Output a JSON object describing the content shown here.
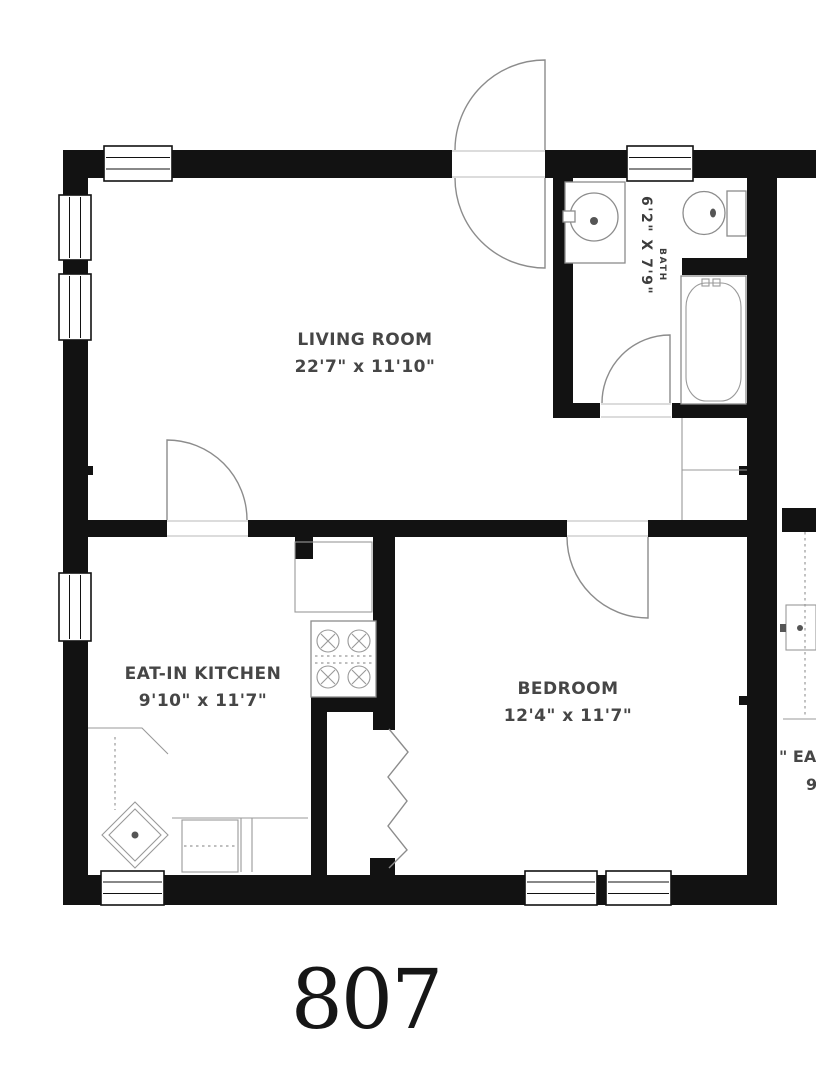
{
  "unit": {
    "number": "807"
  },
  "rooms": {
    "living_room": {
      "name": "LIVING ROOM",
      "dimensions": "22'7\" x 11'10\""
    },
    "eat_in_kitchen": {
      "name": "EAT-IN KITCHEN",
      "dimensions": "9'10\" x 11'7\""
    },
    "bedroom": {
      "name": "BEDROOM",
      "dimensions": "12'4\" x 11'7\""
    },
    "bath": {
      "name": "BATH",
      "dimensions": "6'2\" X 7'9\""
    }
  },
  "adjacent_unit": {
    "label_partial": "\" EA",
    "dimensions_partial": "9"
  },
  "fixtures": {
    "bathroom": [
      "sink-vanity",
      "toilet",
      "bathtub"
    ],
    "kitchen": [
      "refrigerator",
      "stove",
      "corner-sink",
      "dishwasher",
      "counter"
    ],
    "bedroom": [
      "accordion-closet-door"
    ],
    "living_room": [
      "entry-double-swing-door",
      "linen-closet"
    ]
  },
  "colors": {
    "wall": "#121212",
    "fixture_outline": "#8c8c8c",
    "label_text": "#464646",
    "unit_number_text": "#161616",
    "background": "#ffffff"
  }
}
